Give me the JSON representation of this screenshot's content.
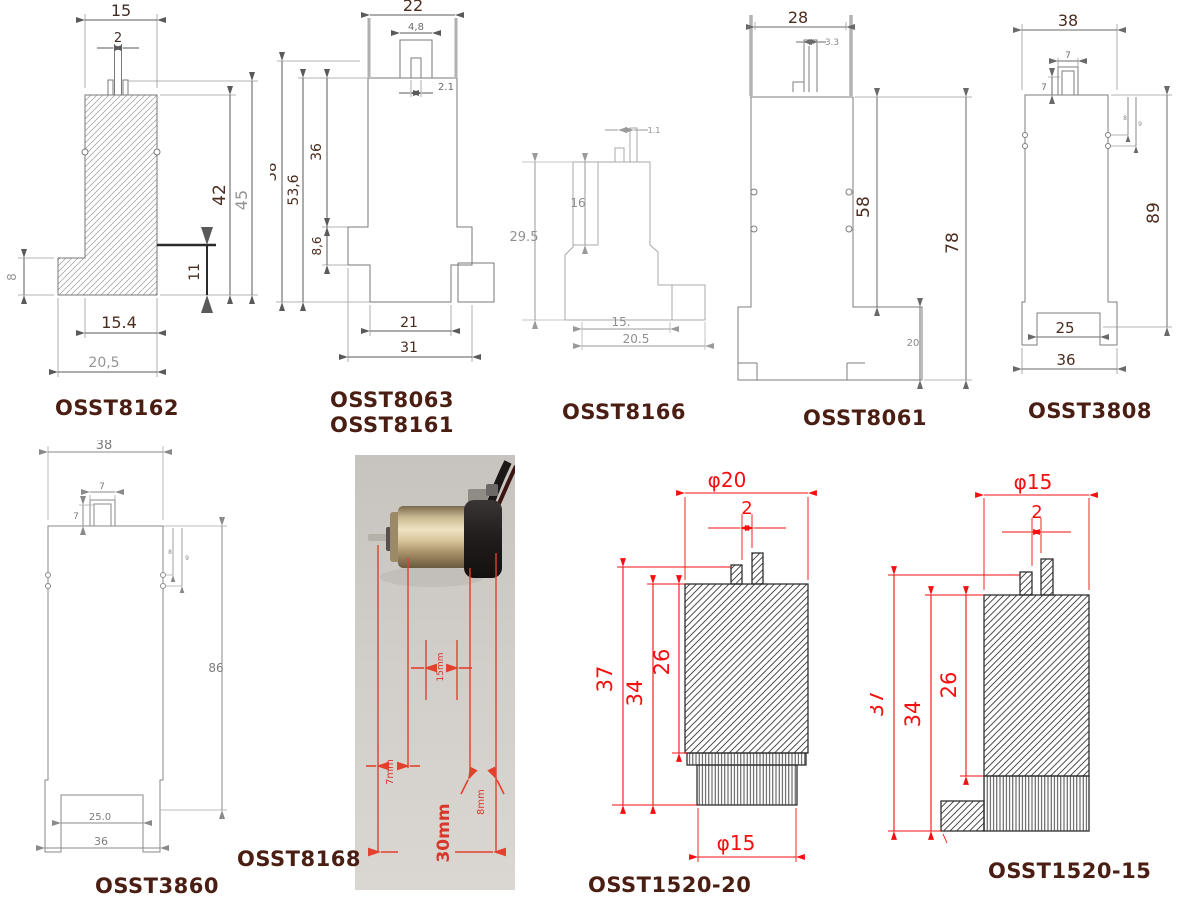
{
  "sheet": {
    "background": "#ffffff",
    "label_color": "#4a1e12",
    "red_accent": "#f50f0f",
    "line_gray": "#7d7d7d"
  },
  "drawings": {
    "osst8162": {
      "label": "OSST8162",
      "dims": {
        "top_width": "15",
        "pin_width": "2",
        "body_height": "42",
        "total_height": "45",
        "step_height": "11",
        "flange_height": "8",
        "body_width": "15.4",
        "base_width": "20,5"
      }
    },
    "osst8063": {
      "label1": "OSST8063",
      "label2": "OSST8161",
      "dims": {
        "top_width": "22",
        "slot_width": "4,8",
        "pin_width": "2.1",
        "total_height": "58",
        "height2": "53,6",
        "upper_height": "36",
        "step_height": "8,6",
        "lower_width": "21",
        "base_width": "31"
      }
    },
    "osst8166": {
      "label": "OSST8166",
      "dims": {
        "pin_width": "1.1",
        "slot_depth": "16",
        "total_height": "29.5",
        "lower_width": "15.",
        "base_width": "20.5"
      }
    },
    "osst8061": {
      "label": "OSST8061",
      "dims": {
        "top_width": "28",
        "pin_width": "3.3",
        "body_height": "58",
        "total_height": "78",
        "base_height": "20"
      }
    },
    "osst3808": {
      "label": "OSST3808",
      "dims": {
        "top_width": "38",
        "pin_width": "7",
        "pin_height": "7",
        "total_height": "89",
        "notch_width": "25",
        "base_width": "36",
        "side_inner": "8",
        "side_outer": "9"
      }
    },
    "osst3860": {
      "label": "OSST3860",
      "dims": {
        "top_width": "38",
        "pin_width": "7",
        "pin_height": "7",
        "body_height": "86",
        "notch_width": "25.0",
        "base_width": "36",
        "side_inner": "8",
        "side_outer": "9"
      }
    },
    "osst8168": {
      "label": "OSST8168",
      "dims": {
        "stroke": "15mm",
        "pin": "7mm",
        "outlet": "8mm",
        "total_length": "30mm"
      }
    },
    "osst1520_20": {
      "label": "OSST1520-20",
      "dims": {
        "top_diameter": "φ20",
        "pin_width": "2",
        "total_height": "37",
        "height2": "34",
        "body_height": "26",
        "bottom_diameter": "φ15"
      }
    },
    "osst1520_15": {
      "label": "OSST1520-15",
      "dims": {
        "top_diameter": "φ15",
        "pin_width": "2",
        "total_height": "37",
        "height2": "34",
        "body_height": "26"
      }
    }
  }
}
